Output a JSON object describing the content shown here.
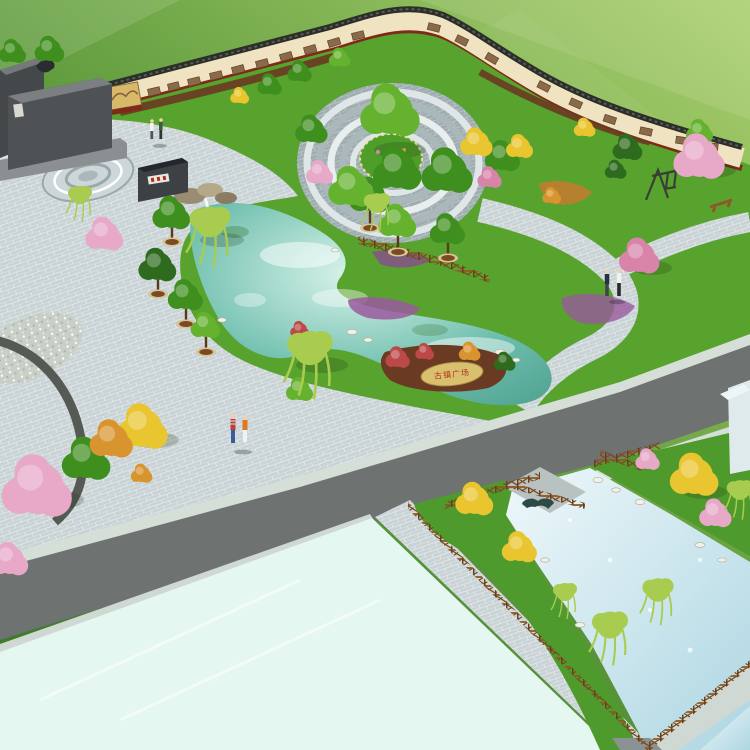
{
  "scene": {
    "kind": "landscape-architecture aerial rendering",
    "description": "Bird's-eye render of a town plaza park: S-curved mural culture wall, circular paved plaza with central tree, kidney-shaped pond with rockery, inscribed stone, tree planters, wooden rail fences, diagonal road, large reflecting pool and a fenced stream with stone arch bridge",
    "people_visible": 6
  },
  "labels": {
    "stone_inscription": "古镇广场"
  },
  "elements": [
    "culture-mural-wall",
    "granite-monument",
    "sculpture",
    "sign-wall-plaque",
    "circular-plaza",
    "central-tree",
    "paving-medallion",
    "pond",
    "rockery-waterfall",
    "inscribed-stone",
    "wooden-fence",
    "tree-planters",
    "willow-trees",
    "blossom-trees",
    "swing-frame",
    "bench",
    "road",
    "sidewalk",
    "reflecting-pool",
    "stream-channel",
    "stone-arch-bridge",
    "building-corner",
    "pedestrians"
  ],
  "colors": {
    "field_light": "#abd06e",
    "field_dark": "#3e7b2b",
    "park_grass": "#58a22e",
    "paver": "#c9d3d5",
    "paver_dark": "#9fadb1",
    "road": "#6e7271",
    "sidewalk": "#d6ded8",
    "pool": "#e4f7f1",
    "pond_light": "#d9f3ea",
    "pond_mid": "#6fbfae",
    "pond_deep": "#4c9f8c",
    "canal_light": "#eef8fa",
    "canal_mid": "#aed6e2",
    "wall_cream": "#f0e3c2",
    "wall_coping": "#2c2e2a",
    "wall_base": "#7e2a18",
    "mural_sepia": "#8a6a49",
    "mulch": "#6b3a22",
    "granite": "#44484b",
    "granite_light": "#75797c",
    "planter_rim": "#d9c497",
    "planter_soil": "#7a4a22",
    "trunk": "#5a3a1a",
    "tree_green": "#3f8f1f",
    "tree_green_bright": "#64b22e",
    "tree_green_dark": "#2e6b1e",
    "tree_yellow": "#e9c52f",
    "tree_orange": "#d8952f",
    "tree_pink": "#e8a8c8",
    "tree_pink_deep": "#d884a8",
    "willow": "#a8cc4f",
    "shrub_red": "#bc4848",
    "shrub_purple": "#9a5a9e",
    "stone": "#d9c06e",
    "stone_text_red": "#b2301f",
    "fence_wood": "#7a4a1e",
    "bridge_stone": "#b8c2c0",
    "rock_white": "#f2f0e8"
  }
}
